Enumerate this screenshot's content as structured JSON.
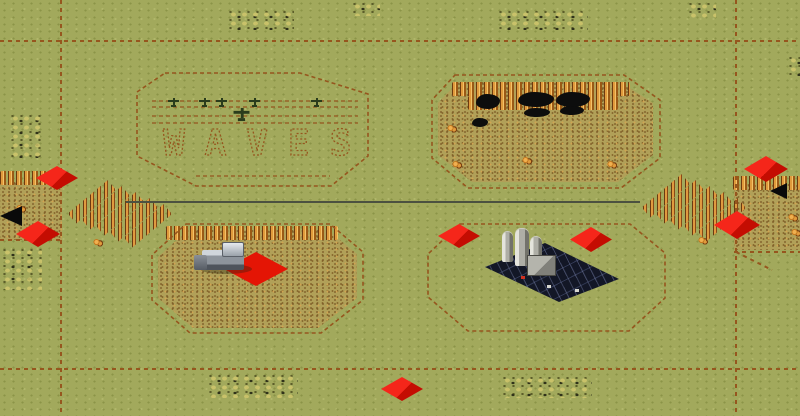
{
  "map": {
    "label": "WAVES",
    "width": 800,
    "height": 416,
    "colors": {
      "grass": "#a2a95c",
      "dirt_field": "#b1a058",
      "path_brown": "#96561e",
      "marker_red": "#e41505",
      "ore_orange": "#d98a2e",
      "refinery_pad": "#131726",
      "road_dark": "#4c5140"
    },
    "zones": [
      {
        "id": "waves",
        "points": "165,73 300,73 368,94 368,156 331,186 196,186 137,156 137,92"
      },
      {
        "id": "ore-north",
        "points": "455,75 624,75 660,100 660,158 621,188 468,188 432,158 432,100"
      },
      {
        "id": "field-south-west",
        "points": "186,224 330,224 363,252 363,300 321,333 190,333 152,300 152,255"
      },
      {
        "id": "field-south-east",
        "points": "460,224 630,224 665,253 665,298 629,331 468,331 428,297 428,254"
      }
    ],
    "lines": [
      {
        "x1": 61,
        "y1": 0,
        "x2": 61,
        "y2": 416,
        "style": "dash"
      },
      {
        "x1": 736,
        "y1": 0,
        "x2": 736,
        "y2": 416,
        "style": "dash"
      },
      {
        "x1": 0,
        "y1": 41,
        "x2": 800,
        "y2": 41,
        "style": "dash"
      },
      {
        "x1": 0,
        "y1": 369,
        "x2": 800,
        "y2": 369,
        "style": "dash"
      },
      {
        "x1": 126,
        "y1": 202,
        "x2": 640,
        "y2": 202,
        "style": "road"
      },
      {
        "x1": 0,
        "y1": 240,
        "x2": 62,
        "y2": 240,
        "style": "dash"
      },
      {
        "x1": 734,
        "y1": 252,
        "x2": 800,
        "y2": 252,
        "style": "dash"
      },
      {
        "x1": 736,
        "y1": 252,
        "x2": 772,
        "y2": 270,
        "style": "dash"
      },
      {
        "x1": 152,
        "y1": 101,
        "x2": 358,
        "y2": 101,
        "style": "thin"
      },
      {
        "x1": 152,
        "y1": 107,
        "x2": 358,
        "y2": 107,
        "style": "thin"
      },
      {
        "x1": 152,
        "y1": 116,
        "x2": 358,
        "y2": 116,
        "style": "thin"
      },
      {
        "x1": 152,
        "y1": 123,
        "x2": 358,
        "y2": 123,
        "style": "thin"
      },
      {
        "x1": 196,
        "y1": 176,
        "x2": 330,
        "y2": 176,
        "style": "thin"
      }
    ],
    "fields": [
      {
        "x": 438,
        "y": 82,
        "w": 215,
        "h": 100,
        "clip": "polygon(20px 0,182px 0,215px 21px,215px 73px,180px 100px,34px 100px,0 73px,0 21px)"
      },
      {
        "x": 158,
        "y": 230,
        "w": 199,
        "h": 98,
        "clip": "polygon(30px 0,170px 0,199px 24px,199px 68px,160px 98px,35px 98px,0 68px,0 27px)"
      },
      {
        "x": 0,
        "y": 182,
        "w": 62,
        "h": 58,
        "clip": ""
      },
      {
        "x": 734,
        "y": 184,
        "w": 66,
        "h": 66,
        "clip": ""
      }
    ],
    "ore_rows": [
      {
        "x": 166,
        "y": 226,
        "w": 172
      },
      {
        "x": 452,
        "y": 82,
        "w": 178
      },
      {
        "x": 468,
        "y": 96,
        "w": 150
      },
      {
        "x": 0,
        "y": 171,
        "w": 52
      },
      {
        "x": 733,
        "y": 176,
        "w": 67
      }
    ],
    "ore_clumps": [
      {
        "x": 93,
        "y": 238
      },
      {
        "x": 447,
        "y": 124
      },
      {
        "x": 452,
        "y": 160
      },
      {
        "x": 522,
        "y": 156
      },
      {
        "x": 607,
        "y": 160
      },
      {
        "x": 788,
        "y": 213
      },
      {
        "x": 791,
        "y": 228
      },
      {
        "x": 16,
        "y": 204
      },
      {
        "x": 698,
        "y": 236
      }
    ],
    "spike_groups": [
      {
        "x": 72,
        "y": 212,
        "rows": 5,
        "dx": 14,
        "dy": 6,
        "len": 52
      },
      {
        "x": 646,
        "y": 206,
        "rows": 5,
        "dx": 14,
        "dy": 6,
        "len": 52
      }
    ],
    "scrub_clusters": [
      {
        "x": 226,
        "y": 8,
        "w": 68,
        "h": 22
      },
      {
        "x": 350,
        "y": 0,
        "w": 30,
        "h": 16
      },
      {
        "x": 496,
        "y": 8,
        "w": 92,
        "h": 22
      },
      {
        "x": 686,
        "y": 0,
        "w": 30,
        "h": 18
      },
      {
        "x": 786,
        "y": 54,
        "w": 14,
        "h": 22
      },
      {
        "x": 8,
        "y": 112,
        "w": 36,
        "h": 46
      },
      {
        "x": 0,
        "y": 246,
        "w": 42,
        "h": 44
      },
      {
        "x": 206,
        "y": 372,
        "w": 92,
        "h": 26
      },
      {
        "x": 500,
        "y": 374,
        "w": 92,
        "h": 24
      }
    ],
    "scorch_marks": [
      {
        "x": 476,
        "y": 94,
        "w": 24,
        "h": 15
      },
      {
        "x": 518,
        "y": 92,
        "w": 36,
        "h": 15
      },
      {
        "x": 556,
        "y": 92,
        "w": 34,
        "h": 15
      },
      {
        "x": 524,
        "y": 108,
        "w": 26,
        "h": 9
      },
      {
        "x": 560,
        "y": 106,
        "w": 24,
        "h": 9
      },
      {
        "x": 472,
        "y": 118,
        "w": 16,
        "h": 9
      }
    ],
    "markers": [
      {
        "x": 36,
        "y": 166,
        "w": 42,
        "h": 24
      },
      {
        "x": 16,
        "y": 221,
        "w": 44,
        "h": 26
      },
      {
        "x": 438,
        "y": 224,
        "w": 42,
        "h": 24
      },
      {
        "x": 570,
        "y": 227,
        "w": 42,
        "h": 25
      },
      {
        "x": 744,
        "y": 156,
        "w": 44,
        "h": 26
      },
      {
        "x": 714,
        "y": 211,
        "w": 46,
        "h": 28
      },
      {
        "x": 381,
        "y": 377,
        "w": 42,
        "h": 24
      },
      {
        "x": 224,
        "y": 252,
        "w": 64,
        "h": 34,
        "tile": true
      }
    ],
    "arrows": [
      {
        "x": 0,
        "y": 206,
        "size": 22
      },
      {
        "x": 770,
        "y": 183,
        "size": 17
      }
    ],
    "aircraft": [
      {
        "x": 168,
        "y": 98
      },
      {
        "x": 199,
        "y": 98
      },
      {
        "x": 216,
        "y": 98
      },
      {
        "x": 249,
        "y": 98
      },
      {
        "x": 311,
        "y": 98
      },
      {
        "x": 236,
        "y": 110,
        "big": true
      }
    ],
    "harvester": {
      "x": 194,
      "y": 238
    },
    "refinery": {
      "x": 483,
      "y": 229
    }
  }
}
